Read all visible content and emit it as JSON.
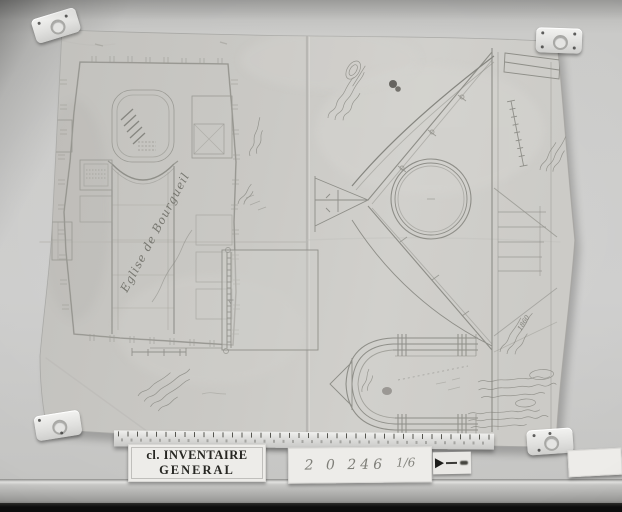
{
  "drawing": {
    "title": "Eglise de Bourgueil",
    "date_annotation": "1860"
  },
  "cards": {
    "inventory": {
      "line1": "cl. INVENTAIRE",
      "line2": "GENERAL"
    },
    "reference": {
      "number": "2 0 246",
      "fraction": "1/6"
    }
  },
  "colors": {
    "wall": "#c9c9c7",
    "paper": "#cac9c5",
    "drawing_ink": "#8e8e88",
    "handwriting": "#7d7d76",
    "ledge": "#adadab",
    "baseboard": "#0d0d0d",
    "card_face": "#edece9",
    "label_text": "#262622"
  }
}
